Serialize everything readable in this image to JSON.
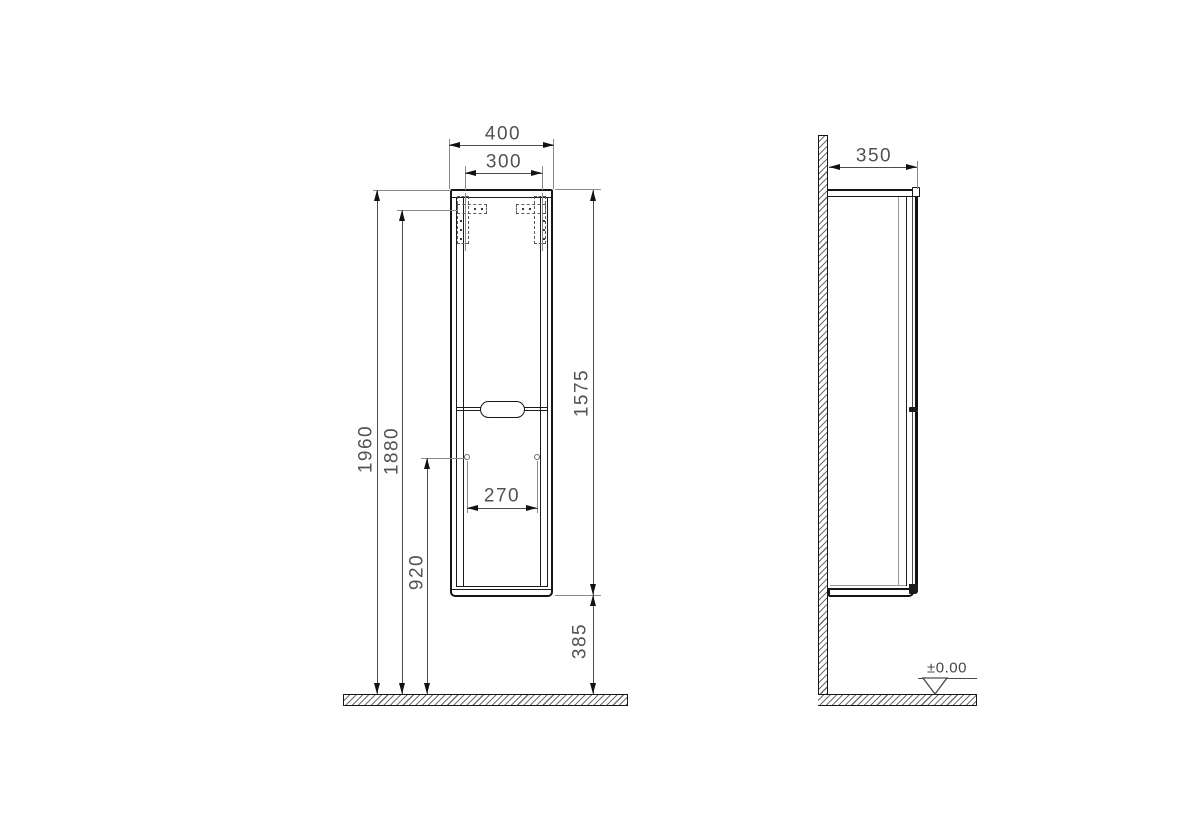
{
  "drawing": {
    "kind": "technical elevation drawing",
    "subject": "wall-hung tall cabinet, front and side views with installation dimensions",
    "front_view": {
      "dim_width_overall": "400",
      "dim_width_brackets": "300",
      "dim_height_overall": "1960",
      "dim_height_bracket_holes": "1880",
      "dim_height_lower_holes": "920",
      "dim_hole_spacing": "270",
      "dim_body_height": "1575",
      "dim_bottom_clearance": "385"
    },
    "side_view": {
      "dim_depth": "350",
      "datum_level": "±0.00"
    },
    "colors": {
      "object_line": "#1b1b1b",
      "dimension_line": "#4c4c4c",
      "extension_line": "#8a8a8a",
      "background": "#ffffff"
    }
  }
}
